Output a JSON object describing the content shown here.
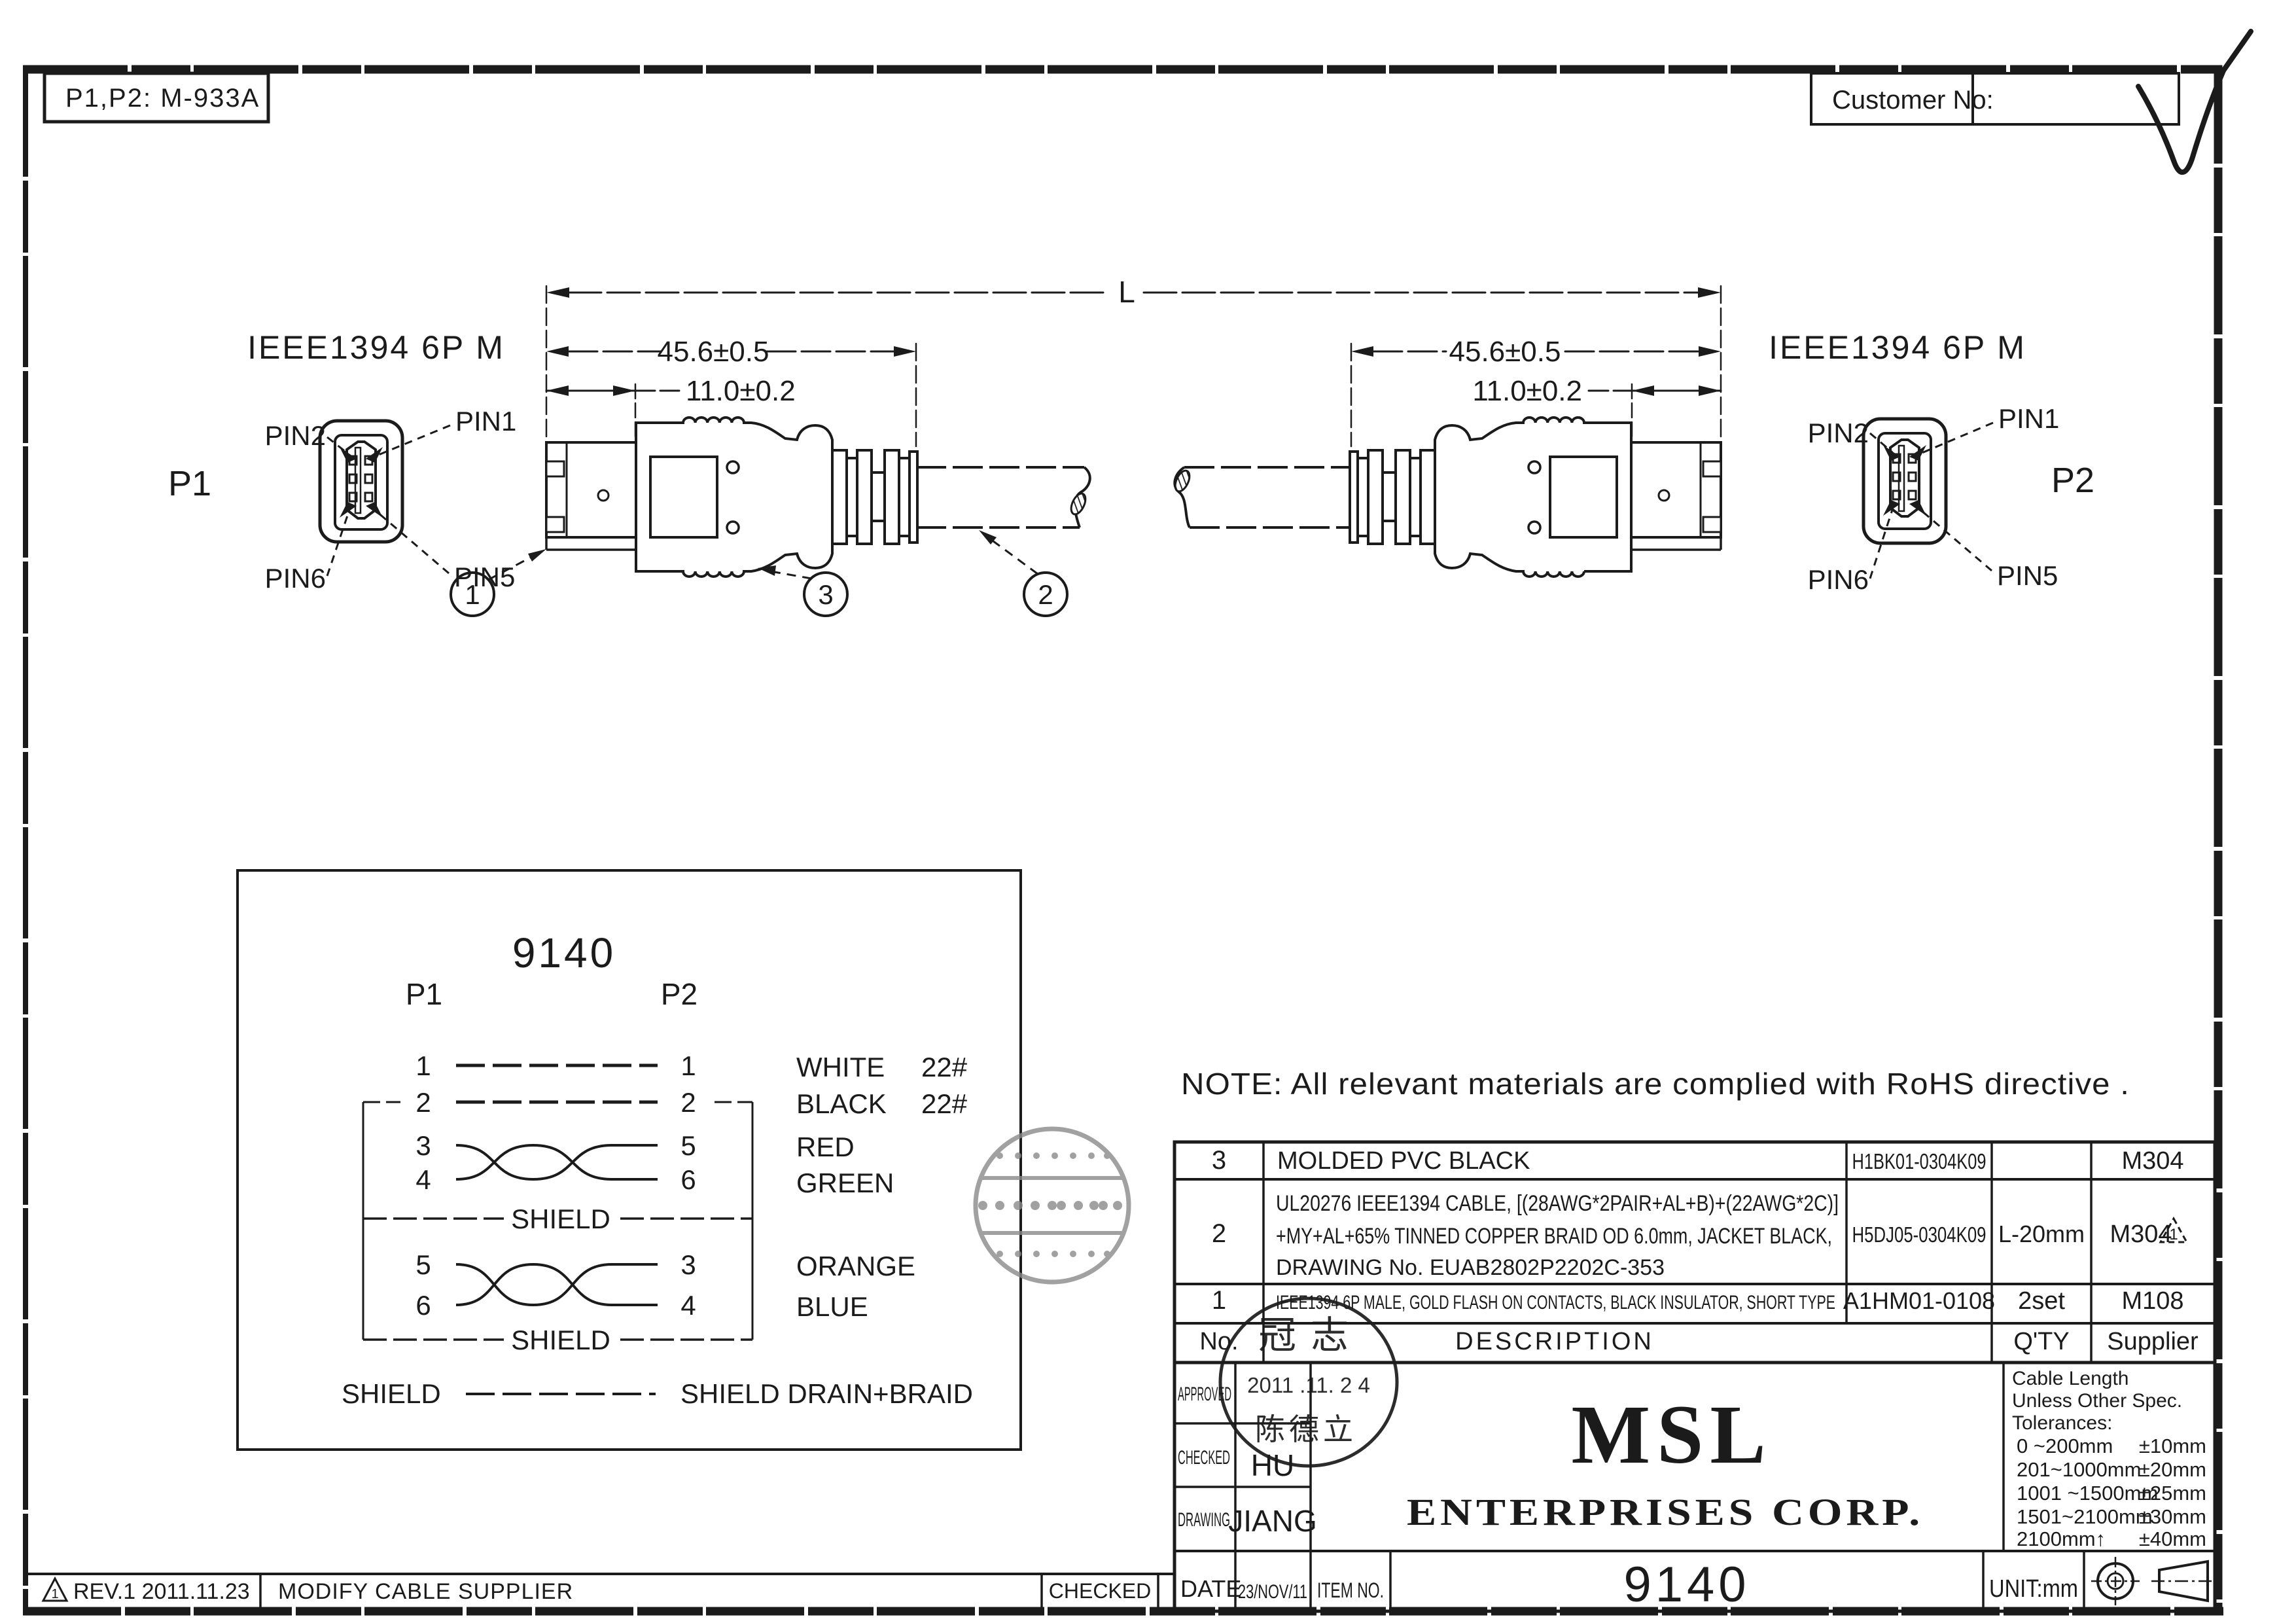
{
  "frame": {
    "ref_label": "P1,P2: M-933A",
    "customer_label": "Customer No:",
    "note": "NOTE: All relevant materials are complied with RoHS directive ."
  },
  "drawing": {
    "connector_title": "IEEE1394 6P M",
    "p1_label": "P1",
    "p2_label": "P2",
    "pins": {
      "pin1": "PIN1",
      "pin2": "PIN2",
      "pin5": "PIN5",
      "pin6": "PIN6"
    },
    "dims": {
      "overall": "L",
      "molding": "45.6±0.5",
      "shell": "11.0±0.2"
    },
    "balloons": {
      "b1": "1",
      "b2": "2",
      "b3": "3"
    }
  },
  "wiring": {
    "title": "9140",
    "p1_header": "P1",
    "p2_header": "P2",
    "rows": [
      {
        "p1": "1",
        "p2": "1",
        "color": "WHITE",
        "gauge": "22#"
      },
      {
        "p1": "2",
        "p2": "2",
        "color": "BLACK",
        "gauge": "22#"
      },
      {
        "p1": "3",
        "p2": "5",
        "color": "RED",
        "gauge": ""
      },
      {
        "p1": "4",
        "p2": "6",
        "color": "GREEN",
        "gauge": ""
      },
      {
        "p1": "5",
        "p2": "3",
        "color": "ORANGE",
        "gauge": ""
      },
      {
        "p1": "6",
        "p2": "4",
        "color": "BLUE",
        "gauge": ""
      }
    ],
    "shield_label": "SHIELD",
    "drain_left": "SHIELD",
    "drain_right": "SHIELD DRAIN+BRAID"
  },
  "bom": {
    "header": {
      "no": "No.",
      "description": "DESCRIPTION",
      "qty": "Q'TY",
      "supplier": "Supplier"
    },
    "rows": [
      {
        "no": "3",
        "desc": "MOLDED PVC BLACK",
        "part_no": "H1BK01-0304K09",
        "qty": "",
        "supplier": "M304"
      },
      {
        "no": "2",
        "desc_line1": "UL20276 IEEE1394 CABLE, [(28AWG*2PAIR+AL+B)+(22AWG*2C)]",
        "desc_line2": "+MY+AL+65% TINNED COPPER BRAID OD 6.0mm, JACKET BLACK,",
        "desc_line3": "DRAWING No. EUAB2802P2202C-353",
        "part_no": "H5DJ05-0304K09",
        "qty": "L-20mm",
        "supplier": "M304",
        "rev_mark": "1"
      },
      {
        "no": "1",
        "desc": "IEEE1394 6P MALE, GOLD FLASH ON CONTACTS, BLACK INSULATOR, SHORT TYPE",
        "part_no": "A1HM01-0108",
        "qty": "2set",
        "supplier": "M108"
      }
    ]
  },
  "title_block": {
    "approved_label": "APPROVED",
    "checked_label": "CHECKED",
    "drawing_label": "DRAWING",
    "date_label": "DATE",
    "checked_value": "HU",
    "drawing_value": "JIANG",
    "date_value": "23/NOV/11",
    "item_no_label": "ITEM NO.",
    "item_no_value": "9140",
    "company_line1": "MSL",
    "company_line2": "ENTERPRISES CORP.",
    "unit_label": "UNIT:mm",
    "stamp": {
      "top": "冠志",
      "date": "2011 .11. 2 4",
      "name": "陈德立"
    },
    "tolerances": {
      "title_line1": "Cable Length",
      "title_line2": "Unless Other Spec.",
      "title_line3": "Tolerances:",
      "rows": [
        {
          "range": "0 ~200mm",
          "tol": "±10mm"
        },
        {
          "range": "201~1000mm",
          "tol": "±20mm"
        },
        {
          "range": "1001 ~1500mm",
          "tol": "±25mm"
        },
        {
          "range": "1501~2100mm",
          "tol": "±30mm"
        },
        {
          "range": "2100mm↑",
          "tol": "±40mm"
        }
      ]
    }
  },
  "revision_strip": {
    "marker": "1",
    "rev_text": "REV.1 2011.11.23",
    "change_text": "MODIFY CABLE SUPPLIER",
    "checked_label": "CHECKED"
  },
  "colors": {
    "ink": "#1b1b1b",
    "stamp_gray": "#8a8a8a",
    "paper": "#ffffff"
  }
}
